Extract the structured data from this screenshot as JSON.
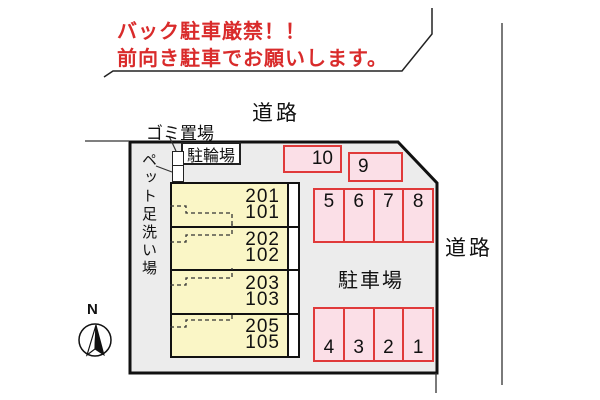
{
  "notice": {
    "line1": "バック駐車厳禁！！",
    "line2": "前向き駐車でお願いします。"
  },
  "roads": {
    "top": "道路",
    "right": "道路"
  },
  "site": {
    "garbage_label": "ゴミ置場",
    "bicycle_label": "駐輪場",
    "pet_wash_label": "ペット足洗い場",
    "parking_lot_label": "駐車場",
    "compass_north": "N"
  },
  "building": {
    "units": [
      {
        "upper": "201",
        "lower": "101"
      },
      {
        "upper": "202",
        "lower": "102"
      },
      {
        "upper": "203",
        "lower": "103"
      },
      {
        "upper": "205",
        "lower": "105"
      }
    ]
  },
  "parking": {
    "space_10": "10",
    "space_9": "9",
    "upper_row": [
      "5",
      "6",
      "7",
      "8"
    ],
    "lower_row": [
      "4",
      "3",
      "2",
      "1"
    ]
  },
  "colors": {
    "notice_red": "#d92b2b",
    "space_fill": "#fbdfe7",
    "space_border": "#e03a3a",
    "unit_fill": "#faf6c6",
    "site_fill": "#ececec",
    "line_black": "#111111"
  }
}
